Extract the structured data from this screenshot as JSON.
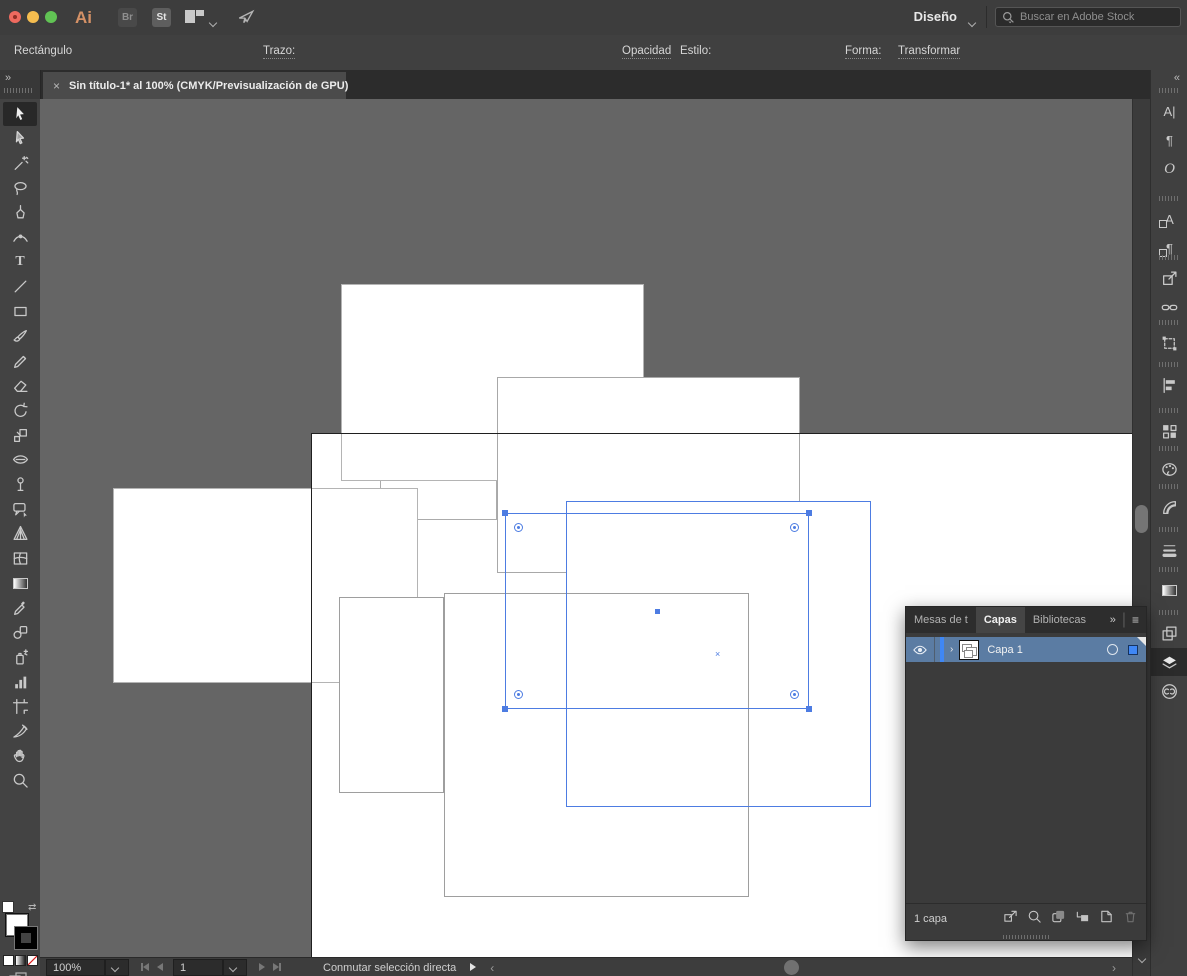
{
  "colors": {
    "accent_blue": "#4d7ce2",
    "canvas_gray": "#656565",
    "artboard_white": "#ffffff",
    "layer_row_blue": "#5b7ca3"
  },
  "menu_bar": {
    "ai_logo": "Ai",
    "bridge_label": "Br",
    "stock_label": "St",
    "workspace_label": "Diseño",
    "search_placeholder": "Buscar en Adobe Stock"
  },
  "control_bar": {
    "context_label": "Rectángulo",
    "stroke_label": "Trazo:",
    "stroke_value": "0,5 pt",
    "profile_value": "Uniforme",
    "brush_value": "Básico",
    "opacity_label": "Opacidad",
    "style_label": "Estilo:",
    "shape_label": "Forma:",
    "transform_label": "Transformar"
  },
  "tab_bar": {
    "close_glyph": "×",
    "title": "Sin título-1* al 100% (CMYK/Previsualización de GPU)",
    "left_expand_glyph": "»"
  },
  "toolbar": {
    "tools": [
      {
        "name": "selection-tool",
        "active": true
      },
      {
        "name": "direct-selection-tool"
      },
      {
        "name": "magic-wand-tool"
      },
      {
        "name": "lasso-tool"
      },
      {
        "name": "pen-tool"
      },
      {
        "name": "curvature-tool"
      },
      {
        "name": "type-tool",
        "glyph": "T"
      },
      {
        "name": "line-segment-tool"
      },
      {
        "name": "rectangle-tool"
      },
      {
        "name": "paintbrush-tool"
      },
      {
        "name": "pencil-tool"
      },
      {
        "name": "eraser-tool"
      },
      {
        "name": "rotate-tool"
      },
      {
        "name": "scale-tool"
      },
      {
        "name": "width-tool"
      },
      {
        "name": "puppet-warp-tool"
      },
      {
        "name": "free-transform-tool"
      },
      {
        "name": "perspective-grid-tool"
      },
      {
        "name": "mesh-tool"
      },
      {
        "name": "gradient-tool"
      },
      {
        "name": "eyedropper-tool"
      },
      {
        "name": "blend-tool"
      },
      {
        "name": "symbol-sprayer-tool"
      },
      {
        "name": "column-graph-tool"
      },
      {
        "name": "artboard-tool"
      },
      {
        "name": "slice-tool"
      },
      {
        "name": "hand-tool"
      },
      {
        "name": "zoom-tool"
      }
    ]
  },
  "canvas": {
    "artboard": {
      "x": 311,
      "y": 433,
      "w": 821,
      "h": 524
    },
    "rects": [
      {
        "name": "rect-1",
        "x": 380,
        "y": 440,
        "w": 117,
        "h": 80,
        "stroke": "#ababab"
      },
      {
        "name": "rect-2",
        "x": 341,
        "y": 284,
        "w": 303,
        "h": 197,
        "stroke": "#b4b4b4"
      },
      {
        "name": "rect-3",
        "x": 497,
        "y": 377,
        "w": 303,
        "h": 196,
        "stroke": "#a8a8a8"
      },
      {
        "name": "rect-4-selected-fill",
        "x": 566,
        "y": 501,
        "w": 305,
        "h": 306,
        "stroke": "none"
      },
      {
        "name": "rect-5",
        "x": 113,
        "y": 488,
        "w": 305,
        "h": 195,
        "stroke": "#b4b4b4"
      },
      {
        "name": "rect-6",
        "x": 339,
        "y": 597,
        "w": 105,
        "h": 196,
        "stroke": "#9e9e9e"
      },
      {
        "name": "rect-7",
        "x": 444,
        "y": 593,
        "w": 305,
        "h": 304,
        "stroke": "#9e9e9e"
      }
    ],
    "selection": {
      "path_outline": {
        "x": 566,
        "y": 501,
        "w": 305,
        "h": 306
      },
      "anchor_box": {
        "x": 505,
        "y": 513,
        "w": 304,
        "h": 196
      },
      "anchors": [
        {
          "x": 505,
          "y": 513
        },
        {
          "x": 809,
          "y": 513
        },
        {
          "x": 505,
          "y": 709
        },
        {
          "x": 809,
          "y": 709
        }
      ],
      "corner_widgets": [
        {
          "x": 519,
          "y": 528
        },
        {
          "x": 795,
          "y": 528
        },
        {
          "x": 519,
          "y": 695
        },
        {
          "x": 795,
          "y": 695
        }
      ],
      "center_square": {
        "x": 657,
        "y": 611
      },
      "x_marker": {
        "x": 719,
        "y": 654,
        "glyph": "×"
      }
    }
  },
  "right_strip": {
    "collapse_glyph": "«",
    "groups": [
      [
        "character-panel-icon",
        "paragraph-panel-icon",
        "opentype-panel-icon"
      ],
      [
        "character-styles-icon",
        "paragraph-styles-icon"
      ],
      [
        "export-panel-icon",
        "links-panel-icon"
      ],
      [
        "transform-panel-icon"
      ],
      [
        "align-panel-icon"
      ],
      [
        "artboards-panel-icon"
      ],
      [
        "color-panel-icon"
      ],
      [
        "color-guide-panel-icon"
      ],
      [
        "stroke-panel-icon"
      ],
      [
        "gradient-panel-icon"
      ],
      [
        "pathfinder-panel-icon",
        "layers-panel-icon",
        "cc-libraries-panel-icon"
      ]
    ],
    "active_icon": "layers-panel-icon"
  },
  "layers_panel": {
    "tabs": [
      {
        "label": "Mesas de t"
      },
      {
        "label": "Capas",
        "active": true
      },
      {
        "label": "Bibliotecas"
      }
    ],
    "more_glyph": "»",
    "menu_glyph": "≡",
    "disclosure_glyph": "›",
    "layer": {
      "name": "Capa 1"
    },
    "footer": {
      "count_label": "1 capa",
      "icons": [
        "collect-for-export-icon",
        "locate-object-icon",
        "make-clipping-mask-icon",
        "new-sublayer-icon",
        "new-layer-icon",
        "delete-layer-icon"
      ]
    }
  },
  "status_bar": {
    "zoom_value": "100%",
    "artboard_number": "1",
    "mode_label": "Conmutar selección directa"
  },
  "scrollbars": {
    "v_thumb_y": 505,
    "v_thumb_h": 28,
    "h_thumb_x": 784
  }
}
